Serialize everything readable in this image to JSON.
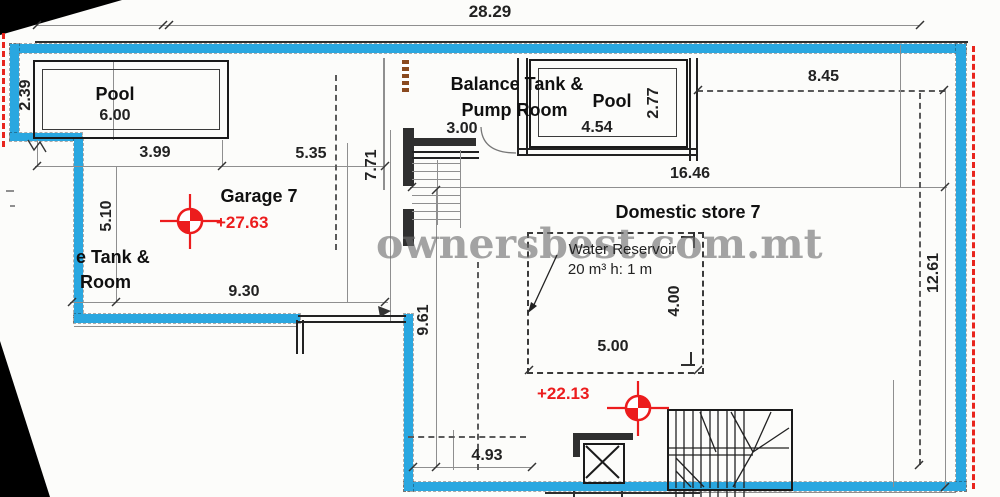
{
  "watermark": "ownersbest.com.mt",
  "colors": {
    "boundary_blue": "#2AA7E0",
    "marker_red": "#EC1C1D"
  },
  "rooms": {
    "pool1": "Pool",
    "balance_tank_line1": "Balance Tank &",
    "balance_tank_line2": "Pump Room",
    "pool2": "Pool",
    "garage": "Garage 7",
    "domestic_store": "Domestic store 7",
    "left_partial_line1": "e Tank &",
    "left_partial_line2": "Room",
    "reservoir_title": "Water Reservoir",
    "reservoir_spec": "20 m³ h: 1 m"
  },
  "levels": {
    "garage": "+27.63",
    "store": "+22.13"
  },
  "dims": {
    "total_width": "28.29",
    "pool1_v": "2.39",
    "pool1_w": "6.00",
    "d399": "3.99",
    "d535": "5.35",
    "d771": "7.71",
    "d510": "5.10",
    "d930": "9.30",
    "pump_w": "3.00",
    "pool2_w": "4.54",
    "pool2_v": "2.77",
    "d845": "8.45",
    "d1646": "16.46",
    "d1261": "12.61",
    "res_h": "4.00",
    "res_w": "5.00",
    "d961": "9.61",
    "d493": "4.93"
  }
}
